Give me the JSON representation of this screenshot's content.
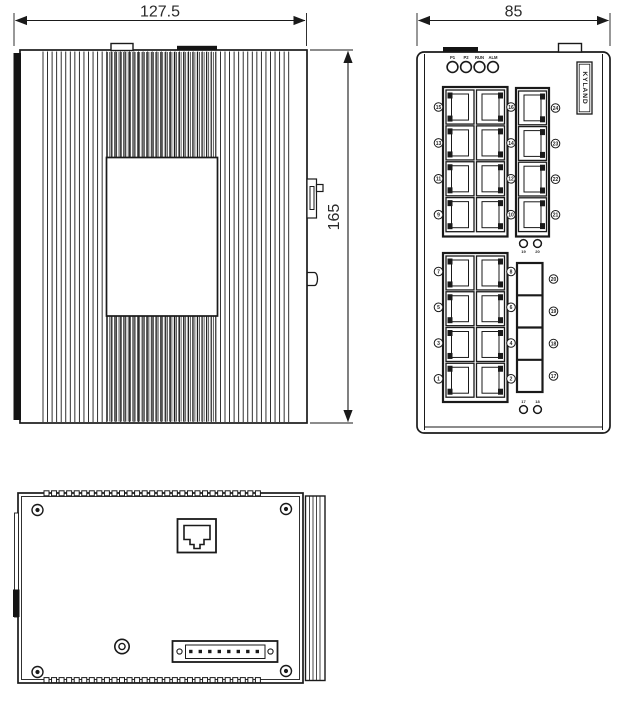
{
  "drawing": {
    "type": "mechanical-outline-drawing",
    "line_color": "#1a1a1a",
    "bg_color": "#ffffff",
    "dimensions": {
      "side_width": "127.5",
      "front_width": "85",
      "height": "165"
    },
    "views": {
      "side": "side view",
      "front": "front view",
      "bottom": "bottom view"
    },
    "front": {
      "led_labels": [
        "P1",
        "P2",
        "RUN",
        "ALM"
      ],
      "brand_label": "KYLAND",
      "upper_left_port_numbers_left": [
        "15",
        "13",
        "11",
        "9"
      ],
      "upper_left_port_numbers_right": [
        "16",
        "14",
        "12",
        "10"
      ],
      "upper_right_port_numbers": [
        "24",
        "23",
        "22",
        "21"
      ],
      "lower_left_port_numbers_left": [
        "7",
        "5",
        "3",
        "1"
      ],
      "lower_left_port_numbers_right": [
        "8",
        "6",
        "4",
        "2"
      ],
      "sfp_port_numbers": [
        "20",
        "19",
        "18",
        "17"
      ],
      "mid_led_pair_labels": [
        "19",
        "20"
      ],
      "bottom_led_pair_labels": [
        "17",
        "18"
      ]
    }
  }
}
